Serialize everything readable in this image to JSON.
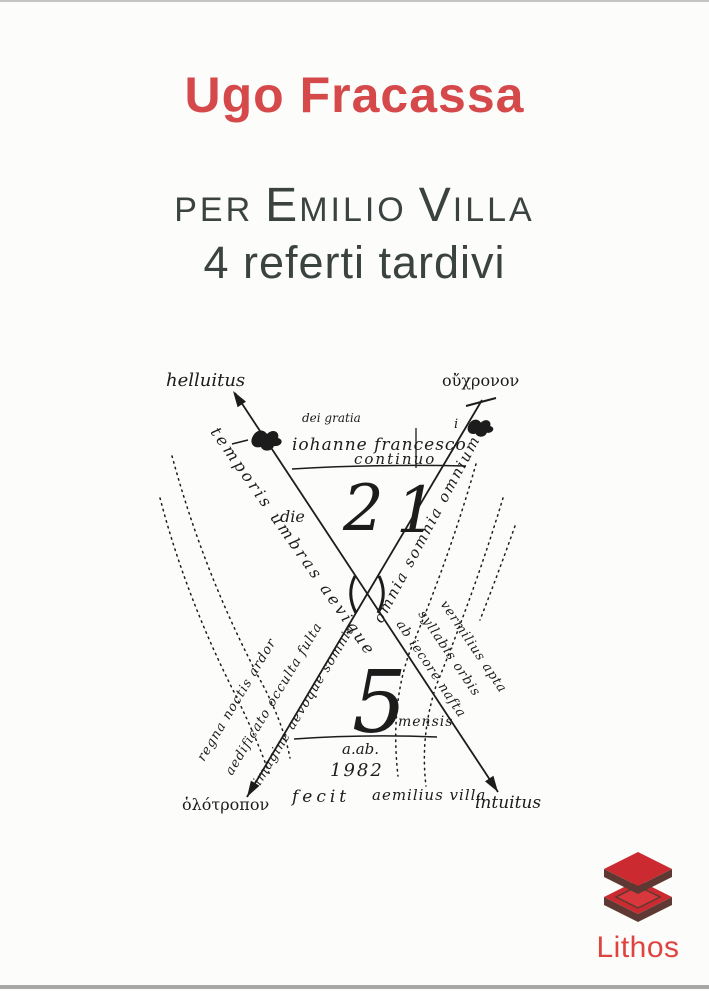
{
  "colors": {
    "accent_red": "#d5494b",
    "title_gray": "#3b4340",
    "ink": "#1c1c1c",
    "logo_red": "#cb2a30",
    "logo_red_light": "#d8383c",
    "logo_dark": "#5e3933",
    "logo_text_red": "#df4340"
  },
  "cover": {
    "author": "Ugo Fracassa",
    "title": {
      "prefix": "per",
      "name1_initial": "E",
      "name1_rest": "milio",
      "name2_initial": "V",
      "name2_rest": "illa"
    },
    "subtitle": "4 referti tardivi"
  },
  "drawing": {
    "corner_top_left": "helluitus",
    "corner_top_right": "οὔχρονον",
    "corner_bottom_left": "ὁλότροπον",
    "corner_bottom_right": "intuitus",
    "center_top": {
      "line1": "dei gratia",
      "line2": "iohanne francesco",
      "line2_sup": "i",
      "line3": "continuo",
      "digit_tens": "2",
      "digit_ones": "1",
      "number_label": "die"
    },
    "center_bottom": {
      "big_number": "5",
      "number_label": "mensis",
      "date_line1": "a.ab.",
      "date_line2": "1982"
    },
    "bottom_caption_fecit": "fecit",
    "bottom_caption_name": "aemilius villa",
    "diagonals": {
      "left_upper": "temporis umbras aevique",
      "left_lower": [
        "imagine aevoque somnia",
        "aedificato occulta fulta",
        "regna noctis ardor"
      ],
      "right_upper": "omnia somnia omnium",
      "right_lower": [
        "ab iecore nafta",
        "syllabis orbis",
        "vermilius apta"
      ]
    }
  },
  "publisher": {
    "name": "Lithos",
    "logo": "stacked-slabs-icon"
  }
}
